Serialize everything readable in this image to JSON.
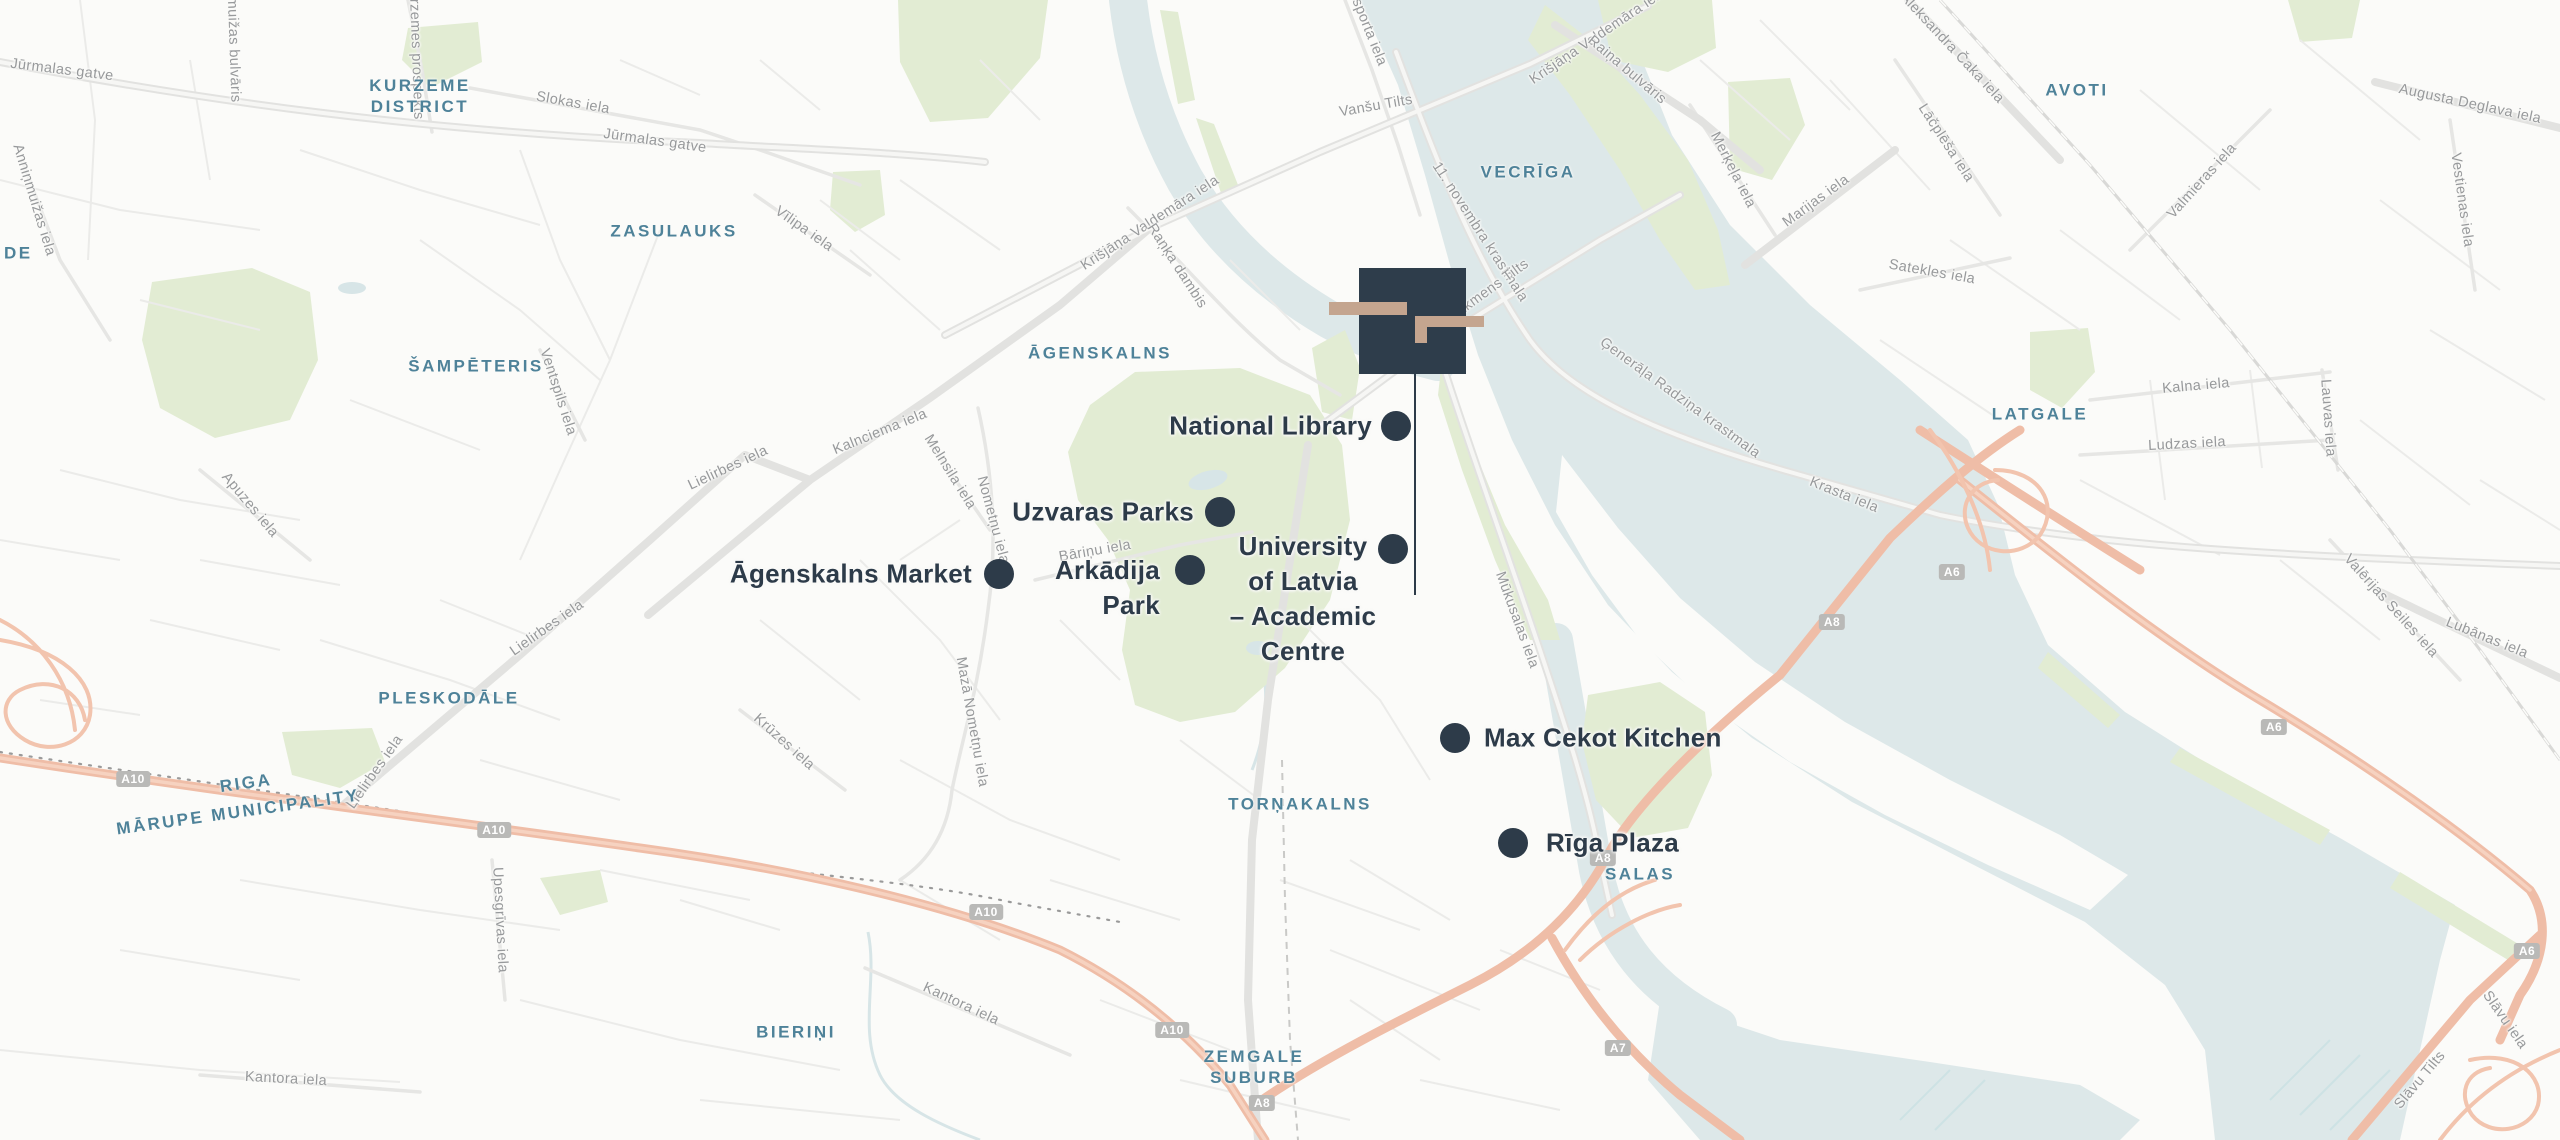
{
  "map": {
    "site_marker": {
      "name": "site-logo-marker"
    },
    "pois": [
      {
        "id": "national-library",
        "dot": {
          "x": 1396,
          "y": 426
        },
        "label": {
          "lines": [
            "National Library"
          ],
          "x": 1372,
          "y": 426,
          "align": "right"
        }
      },
      {
        "id": "uzvaras-parks",
        "dot": {
          "x": 1220,
          "y": 512
        },
        "label": {
          "lines": [
            "Uzvaras Parks"
          ],
          "x": 1194,
          "y": 512,
          "align": "right"
        }
      },
      {
        "id": "agenskalns-market",
        "dot": {
          "x": 999,
          "y": 574
        },
        "label": {
          "lines": [
            "Āgenskalns Market"
          ],
          "x": 972,
          "y": 574,
          "align": "right"
        }
      },
      {
        "id": "arkadija-park",
        "dot": {
          "x": 1190,
          "y": 570
        },
        "label": {
          "lines": [
            "Arkādija",
            "Park"
          ],
          "x": 1160,
          "y": 570,
          "align": "right"
        }
      },
      {
        "id": "university-of-latvia",
        "dot": {
          "x": 1393,
          "y": 549
        },
        "label": {
          "lines": [
            "University",
            "of Latvia",
            "– Academic",
            "Centre"
          ],
          "x": 1303,
          "y": 546,
          "align": "center"
        }
      },
      {
        "id": "max-cekot-kitchen",
        "dot": {
          "x": 1455,
          "y": 738
        },
        "label": {
          "lines": [
            "Max Cekot Kitchen"
          ],
          "x": 1484,
          "y": 738,
          "align": "left"
        }
      },
      {
        "id": "riga-plaza",
        "dot": {
          "x": 1513,
          "y": 843
        },
        "label": {
          "lines": [
            "Rīga Plaza"
          ],
          "x": 1546,
          "y": 843,
          "align": "left"
        }
      }
    ],
    "districts": [
      {
        "lines": [
          "KURZEME",
          "DISTRICT"
        ],
        "x": 420,
        "y": 96,
        "rot": 0
      },
      {
        "lines": [
          "ZASULAUKS"
        ],
        "x": 674,
        "y": 231,
        "rot": 0
      },
      {
        "lines": [
          "ŠAMPĒTERIS"
        ],
        "x": 476,
        "y": 366,
        "rot": 0
      },
      {
        "lines": [
          "ĀGENSKALNS"
        ],
        "x": 1100,
        "y": 353,
        "rot": 0
      },
      {
        "lines": [
          "VECRĪGA"
        ],
        "x": 1528,
        "y": 172,
        "rot": 0
      },
      {
        "lines": [
          "AVOTI"
        ],
        "x": 2077,
        "y": 90,
        "rot": 0
      },
      {
        "lines": [
          "LATGALE"
        ],
        "x": 2040,
        "y": 414,
        "rot": 0
      },
      {
        "lines": [
          "PLESKODĀLE"
        ],
        "x": 449,
        "y": 698,
        "rot": 0
      },
      {
        "lines": [
          "RIGA"
        ],
        "x": 246,
        "y": 783,
        "rot": -8
      },
      {
        "lines": [
          "MĀRUPE MUNICIPALITY"
        ],
        "x": 238,
        "y": 812,
        "rot": -8
      },
      {
        "lines": [
          "TORŅAKALNS"
        ],
        "x": 1300,
        "y": 804,
        "rot": 0
      },
      {
        "lines": [
          "SALAS"
        ],
        "x": 1640,
        "y": 874,
        "rot": 0
      },
      {
        "lines": [
          "BIERIŅI"
        ],
        "x": 796,
        "y": 1032,
        "rot": 0
      },
      {
        "lines": [
          "ZEMGALE",
          "SUBURB"
        ],
        "x": 1254,
        "y": 1067,
        "rot": 0
      },
      {
        "lines": [
          "DE"
        ],
        "x": 4,
        "y": 253,
        "rot": 0,
        "edge": true
      }
    ],
    "streets": [
      {
        "text": "Jūrmalas gatve",
        "x": 62,
        "y": 70,
        "rot": 7
      },
      {
        "text": "Jūrmalas gatve",
        "x": 655,
        "y": 141,
        "rot": 8
      },
      {
        "text": "Slokas iela",
        "x": 573,
        "y": 103,
        "rot": 10
      },
      {
        "text": "Kurzemes prospekts",
        "x": 416,
        "y": 50,
        "rot": 88
      },
      {
        "text": "Anniņmuižas bulvāris",
        "x": 233,
        "y": 30,
        "rot": 88
      },
      {
        "text": "Anniņmuižas iela",
        "x": 34,
        "y": 200,
        "rot": 73
      },
      {
        "text": "Vīlipa iela",
        "x": 804,
        "y": 229,
        "rot": 35
      },
      {
        "text": "Krišjāņa Valdemāra iela",
        "x": 1150,
        "y": 223,
        "rot": -33
      },
      {
        "text": "Raņķa dambis",
        "x": 1177,
        "y": 266,
        "rot": 57
      },
      {
        "text": "Vanšu Tilts",
        "x": 1376,
        "y": 106,
        "rot": -10
      },
      {
        "text": "Eksporta iela",
        "x": 1366,
        "y": 24,
        "rot": 68
      },
      {
        "text": "11. novembra krastmala",
        "x": 1480,
        "y": 232,
        "rot": 57
      },
      {
        "text": "Krišjāņa Valdemāra iela",
        "x": 1598,
        "y": 36,
        "rot": -34
      },
      {
        "text": "Raiņa bulvāris",
        "x": 1627,
        "y": 70,
        "rot": 40
      },
      {
        "text": "Merķeļa iela",
        "x": 1733,
        "y": 170,
        "rot": 63
      },
      {
        "text": "Marijas iela",
        "x": 1816,
        "y": 201,
        "rot": -36
      },
      {
        "text": "Aleksandra Čaka iela",
        "x": 1952,
        "y": 48,
        "rot": 47
      },
      {
        "text": "Lāčplēša iela",
        "x": 1946,
        "y": 143,
        "rot": 57
      },
      {
        "text": "Satekles iela",
        "x": 1932,
        "y": 272,
        "rot": 10
      },
      {
        "text": "Valmieras iela",
        "x": 2202,
        "y": 181,
        "rot": -48
      },
      {
        "text": "Augusta Deglava iela",
        "x": 2470,
        "y": 104,
        "rot": 12
      },
      {
        "text": "Vestienas iela",
        "x": 2462,
        "y": 200,
        "rot": 82
      },
      {
        "text": "Kalna iela",
        "x": 2196,
        "y": 386,
        "rot": -5
      },
      {
        "text": "Ludzas iela",
        "x": 2187,
        "y": 444,
        "rot": -3
      },
      {
        "text": "Lauvas iela",
        "x": 2328,
        "y": 418,
        "rot": 86
      },
      {
        "text": "Valērijas Seiles iela",
        "x": 2391,
        "y": 606,
        "rot": 48
      },
      {
        "text": "Lubānas iela",
        "x": 2487,
        "y": 638,
        "rot": 22
      },
      {
        "text": "Krasta iela",
        "x": 1844,
        "y": 495,
        "rot": 22
      },
      {
        "text": "Ģenerāļa Radziņa krastmala",
        "x": 1680,
        "y": 398,
        "rot": 36
      },
      {
        "text": "Mūkusalas iela",
        "x": 1517,
        "y": 620,
        "rot": 70
      },
      {
        "text": "Akmens Tilts",
        "x": 1492,
        "y": 288,
        "rot": -36
      },
      {
        "text": "Bāriņu iela",
        "x": 1095,
        "y": 551,
        "rot": -10
      },
      {
        "text": "Nometņu iela",
        "x": 993,
        "y": 520,
        "rot": 75
      },
      {
        "text": "Mazā Nometņu iela",
        "x": 972,
        "y": 722,
        "rot": 80
      },
      {
        "text": "Kalnciema iela",
        "x": 880,
        "y": 432,
        "rot": -22
      },
      {
        "text": "Melnsila iela",
        "x": 950,
        "y": 472,
        "rot": 58
      },
      {
        "text": "Lielirbes iela",
        "x": 728,
        "y": 468,
        "rot": -25
      },
      {
        "text": "Lielirbes iela",
        "x": 547,
        "y": 628,
        "rot": -35
      },
      {
        "text": "Lielirbes iela",
        "x": 375,
        "y": 772,
        "rot": -55
      },
      {
        "text": "Ventspils iela",
        "x": 558,
        "y": 392,
        "rot": 72
      },
      {
        "text": "Apuzes iela",
        "x": 250,
        "y": 505,
        "rot": 50
      },
      {
        "text": "Upesgrīvas iela",
        "x": 500,
        "y": 920,
        "rot": 87
      },
      {
        "text": "Kantora iela",
        "x": 961,
        "y": 1004,
        "rot": 25
      },
      {
        "text": "Kantora iela",
        "x": 286,
        "y": 1079,
        "rot": 3
      },
      {
        "text": "Krūzes iela",
        "x": 784,
        "y": 742,
        "rot": 42
      },
      {
        "text": "Slāvu iela",
        "x": 2505,
        "y": 1020,
        "rot": 55
      },
      {
        "text": "Slāvu Tilts",
        "x": 2420,
        "y": 1080,
        "rot": -50
      }
    ],
    "shields": [
      {
        "text": "A10",
        "x": 133,
        "y": 779
      },
      {
        "text": "A10",
        "x": 494,
        "y": 830
      },
      {
        "text": "A10",
        "x": 986,
        "y": 912
      },
      {
        "text": "A10",
        "x": 1172,
        "y": 1030
      },
      {
        "text": "A8",
        "x": 1262,
        "y": 1103
      },
      {
        "text": "A7",
        "x": 1618,
        "y": 1048
      },
      {
        "text": "A8",
        "x": 1603,
        "y": 858
      },
      {
        "text": "A8",
        "x": 1832,
        "y": 622
      },
      {
        "text": "A6",
        "x": 1952,
        "y": 572
      },
      {
        "text": "A6",
        "x": 2274,
        "y": 727
      },
      {
        "text": "A6",
        "x": 2527,
        "y": 951
      }
    ]
  },
  "colors": {
    "background": "#fbfbf9",
    "water": "#dde8e9",
    "park": "#e2ecd3",
    "poi": "#2d3b49",
    "district_label": "#4e8299",
    "street_label": "#97999b",
    "shield_bg": "#b9b9b7",
    "highway": "#efbda7",
    "logo_navy": "#2e3d4b",
    "logo_tan": "#c4a58f"
  }
}
